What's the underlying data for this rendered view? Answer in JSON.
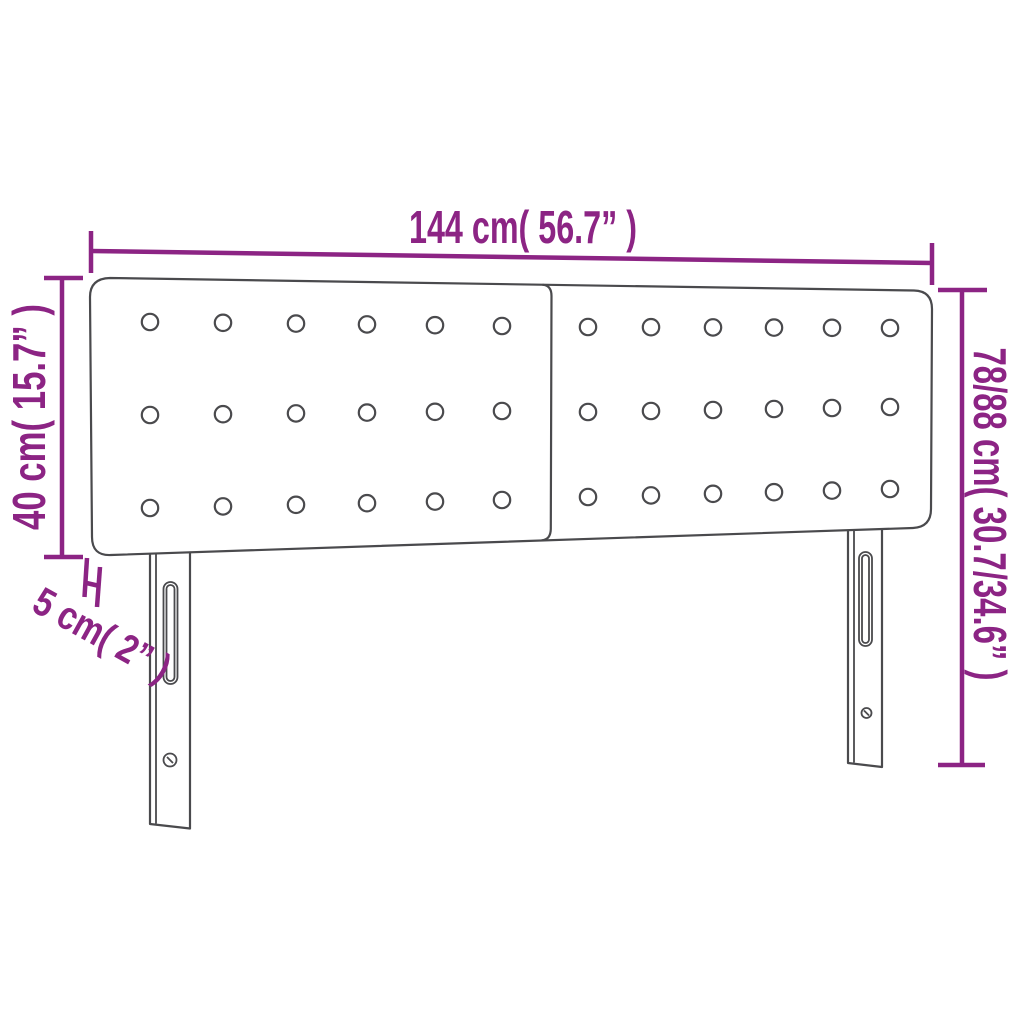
{
  "diagram": {
    "kind": "headboard-dimension-diagram",
    "dimensions": {
      "width": {
        "label": "144 cm( 56.7” )"
      },
      "board_height": {
        "label": "40 cm( 15.7” )"
      },
      "total_height": {
        "label": "78/88 cm( 30.7/34.6” )"
      },
      "thickness": {
        "label": "5 cm( 2” )"
      }
    },
    "panels": [
      {
        "name": "left-panel",
        "button_rows": 3,
        "button_cols": 6
      },
      {
        "name": "right-panel",
        "button_rows": 3,
        "button_cols": 6
      }
    ],
    "legs": [
      {
        "name": "left-leg",
        "features": [
          "slot",
          "screw-hole"
        ]
      },
      {
        "name": "right-leg",
        "features": [
          "slot",
          "screw-hole"
        ]
      }
    ],
    "colors": {
      "dimension": "#8c2484",
      "outline": "#4a4a4d",
      "background": "#ffffff"
    }
  }
}
